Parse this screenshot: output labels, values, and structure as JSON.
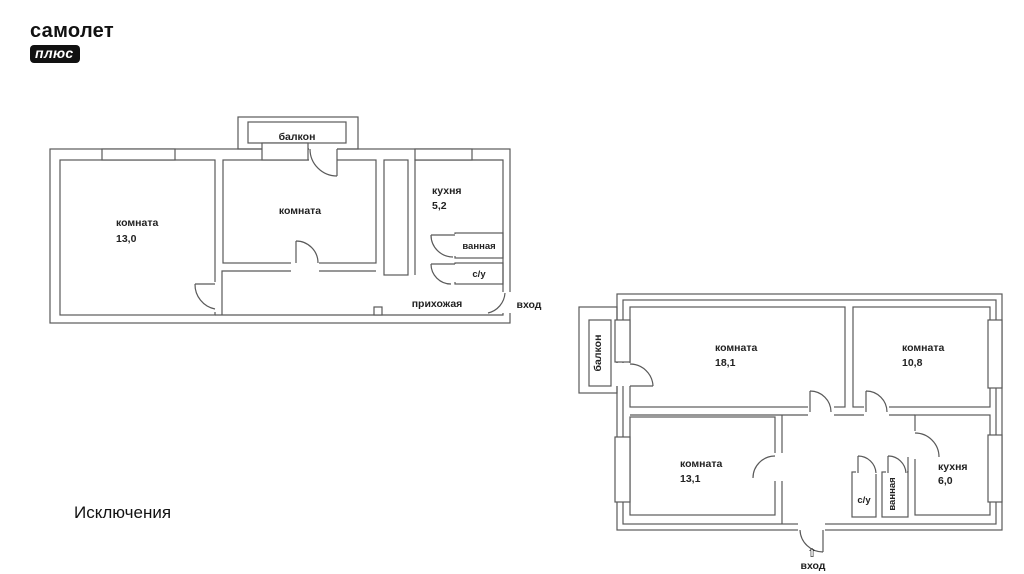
{
  "logo": {
    "line1": "самолет",
    "line2": "плюс"
  },
  "caption": "Исключения",
  "colors": {
    "line": "#595959",
    "label": "#222222",
    "logo_bg": "#111111",
    "background": "#ffffff"
  },
  "plan1": {
    "balcony_label": "балкон",
    "room_left_label": "комната",
    "room_left_area": "13,0",
    "room_center_label": "комната",
    "kitchen_label": "кухня",
    "kitchen_area": "5,2",
    "bathroom_label": "ванная",
    "wc_label": "с/у",
    "hallway_label": "прихожая",
    "entrance_label": "вход"
  },
  "plan2": {
    "balcony_label": "балкон",
    "room_top_left_label": "комната",
    "room_top_left_area": "18,1",
    "room_top_right_label": "комната",
    "room_top_right_area": "10,8",
    "room_bottom_left_label": "комната",
    "room_bottom_left_area": "13,1",
    "kitchen_label": "кухня",
    "kitchen_area": "6,0",
    "wc_label": "с/у",
    "bathroom_label": "ванная",
    "entrance_label": "вход",
    "entrance_arrow": "⇧"
  }
}
